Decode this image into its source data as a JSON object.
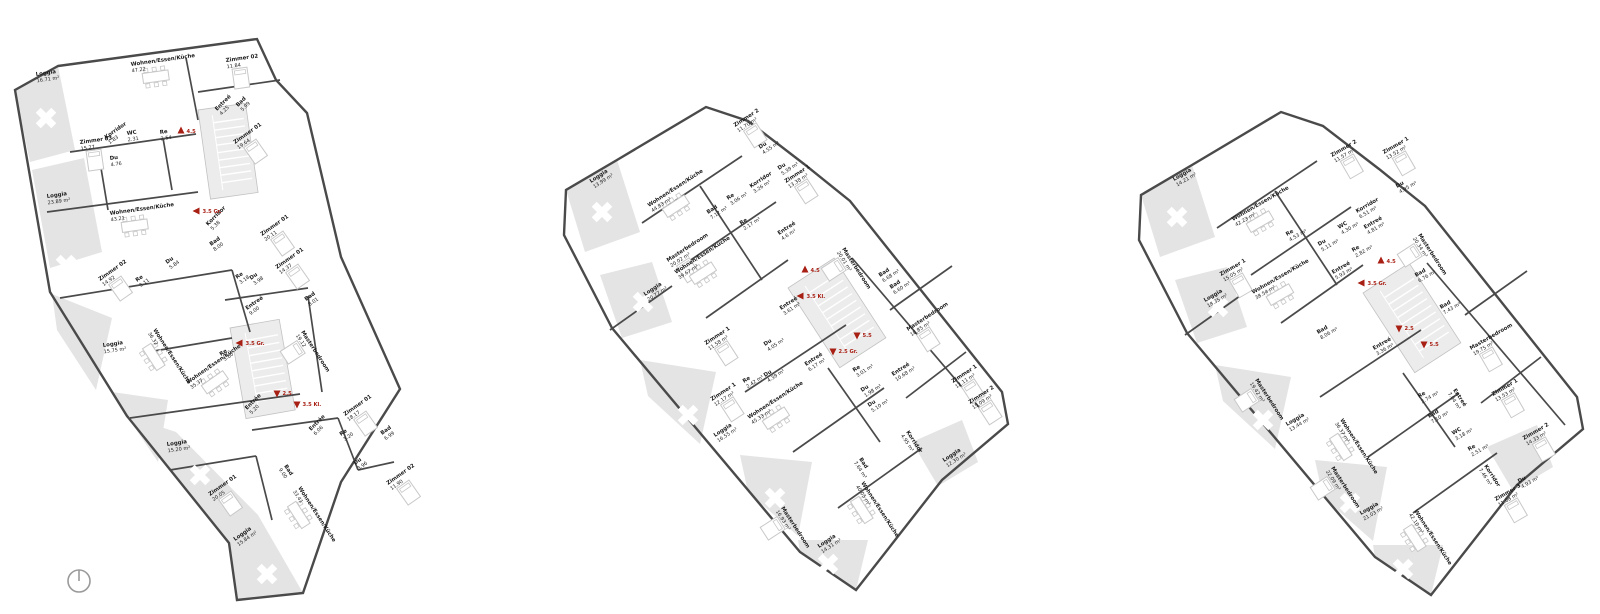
{
  "drawing": {
    "type": "architectural-floor-plans",
    "language": "de",
    "background": "#ffffff"
  },
  "colors": {
    "wall": "#4a4a4a",
    "light_detail": "#c8c8c8",
    "loggia_fill": "#e4e4e4",
    "stair_fill": "#ececec",
    "stair_edge": "#c2c2c2",
    "marker_red": "#a81f14",
    "text": "#1c1c1c",
    "north_arrow": "#9a9a9a"
  },
  "plans": [
    {
      "id": "floor-plan-left",
      "angle": -8,
      "rooms": [
        [
          "Loggia",
          "16.71 m²",
          36,
          76,
          -8
        ],
        [
          "Wohnen/Essen/Küche",
          "47.22",
          131,
          66,
          -8
        ],
        [
          "Zimmer 02",
          "11.84",
          226,
          62,
          -8
        ],
        [
          "Entreé",
          "4.25",
          217,
          111,
          -45
        ],
        [
          "Bad",
          "5.99",
          238,
          107,
          -45
        ],
        [
          "Zimmer 01",
          "19.64",
          235,
          144,
          -35
        ],
        [
          "Zimmer 03",
          "15.27",
          80,
          144,
          -8
        ],
        [
          "Korridor",
          "1.83",
          106,
          139,
          -35
        ],
        [
          "WC",
          "2.31",
          127,
          135,
          -8
        ],
        [
          "Re",
          "2.54",
          160,
          134,
          -8
        ],
        [
          "Du",
          "4.76",
          110,
          160,
          -8
        ],
        [
          "Loggia",
          "23.89 m²",
          47,
          198,
          -8
        ],
        [
          "Wohnen/Essen/Küche",
          "43.21",
          110,
          215,
          -8
        ],
        [
          "Korridor",
          "5.38",
          208,
          226,
          -45
        ],
        [
          "Bad",
          "8.00",
          211,
          246,
          -35
        ],
        [
          "Zimmer 01",
          "20.11",
          262,
          236,
          -35
        ],
        [
          "Du",
          "5.84",
          167,
          264,
          -35
        ],
        [
          "Zimmer 02",
          "14.92",
          100,
          281,
          -35
        ],
        [
          "Re",
          "3.11",
          137,
          282,
          -35
        ],
        [
          "Re",
          "3.18",
          237,
          279,
          -35
        ],
        [
          "Du",
          "3.98",
          251,
          280,
          -35
        ],
        [
          "Zimmer 01",
          "14.37",
          277,
          269,
          -35
        ],
        [
          "Bad",
          "8.01",
          306,
          301,
          -35
        ],
        [
          "Entreé",
          "9.00",
          247,
          310,
          -35
        ],
        [
          "Wohnen/Essen/Küche",
          "36.32",
          153,
          330,
          57
        ],
        [
          "Loggia",
          "15.75 m²",
          103,
          347,
          -8
        ],
        [
          "Masterbedroom",
          "19.12",
          301,
          332,
          57
        ],
        [
          "Re",
          "3.60",
          221,
          356,
          -35
        ],
        [
          "Wohnen/Essen/Küche",
          "35.37",
          188,
          384,
          -35
        ],
        [
          "Entrée",
          "5.20",
          247,
          410,
          -45
        ],
        [
          "Loggia",
          "15.20 m²",
          167,
          446,
          -8
        ],
        [
          "Bad",
          "9.00",
          284,
          466,
          57
        ],
        [
          "Zimmer 01",
          "20.05",
          210,
          496,
          -35
        ],
        [
          "Wohnen/Essen/Küche",
          "33.41",
          298,
          488,
          57
        ],
        [
          "Loggia",
          "15.84 m²",
          235,
          541,
          -35
        ],
        [
          "Zimmer 01",
          "18.17",
          345,
          416,
          -35
        ],
        [
          "Entrée",
          "6.06",
          311,
          431,
          -45
        ],
        [
          "Re",
          "3.20",
          341,
          436,
          -35
        ],
        [
          "Bad",
          "6.99",
          382,
          435,
          -35
        ],
        [
          "Du",
          "3.96",
          355,
          465,
          -35
        ],
        [
          "Zimmer 02",
          "11.90",
          388,
          485,
          -35
        ]
      ],
      "markers": [
        [
          "4.5",
          181,
          131,
          "up"
        ],
        [
          "3.5 Gr.",
          197,
          211,
          "left"
        ],
        [
          "3.5 Gr.",
          240,
          343,
          "left"
        ],
        [
          "2.5",
          277,
          393,
          "down"
        ],
        [
          "3.5 Kl.",
          297,
          404,
          "down"
        ]
      ]
    },
    {
      "id": "floor-plan-middle",
      "angle": -33,
      "rooms": [
        [
          "Loggia",
          "13.99 m²",
          591,
          183,
          -33
        ],
        [
          "Zimmer 2",
          "11.70 m²",
          735,
          127,
          -33
        ],
        [
          "Du",
          "4.55 m²",
          760,
          149,
          -33
        ],
        [
          "Du",
          "5.39 m²",
          779,
          170,
          -33
        ],
        [
          "Zimmer 1",
          "13.38 m²",
          786,
          183,
          -33
        ],
        [
          "Korridor",
          "3.26 m²",
          751,
          188,
          -33
        ],
        [
          "Re",
          "3.06 m²",
          728,
          200,
          -33
        ],
        [
          "Bad",
          "7.12 m²",
          708,
          214,
          -33
        ],
        [
          "Re",
          "2.17 m²",
          741,
          225,
          -33
        ],
        [
          "Entreé",
          "4.6 m²",
          779,
          235,
          -33
        ],
        [
          "Wohnen/Essen/Küche",
          "44.83 m²",
          649,
          207,
          -33
        ],
        [
          "Masterbedroom",
          "20.02 m²",
          668,
          262,
          -33
        ],
        [
          "Wohnen/Essen/Küche",
          "39.67 m²",
          676,
          274,
          -33
        ],
        [
          "Loggia",
          "20.77 m²",
          645,
          296,
          -33
        ],
        [
          "Masterbedroom",
          "20.01 m²",
          842,
          249,
          57
        ],
        [
          "Bad",
          "6.68 m²",
          880,
          277,
          -33
        ],
        [
          "Bad",
          "6.60 m²",
          891,
          289,
          -33
        ],
        [
          "Zimmer 1",
          "11.58 m²",
          706,
          345,
          -33
        ],
        [
          "Du",
          "4.05 m²",
          765,
          346,
          -33
        ],
        [
          "Entreé",
          "3.61 m²",
          781,
          310,
          -33
        ],
        [
          "Re",
          "2.42 m²",
          744,
          383,
          -33
        ],
        [
          "Du",
          "4.39 m²",
          765,
          377,
          -33
        ],
        [
          "Entreé",
          "6.17 m²",
          806,
          366,
          -33
        ],
        [
          "Zimmer 1",
          "12.17 m²",
          712,
          401,
          -33
        ],
        [
          "Wohnen/Essen/Küche",
          "45.33 m²",
          749,
          419,
          -33
        ],
        [
          "Loggia",
          "16.55 m²",
          715,
          437,
          -33
        ],
        [
          "Re",
          "3.01 m²",
          854,
          372,
          -33
        ],
        [
          "Du",
          "1.98 m²",
          862,
          392,
          -33
        ],
        [
          "Du",
          "5.10 m²",
          869,
          407,
          -33
        ],
        [
          "Entreé",
          "10.68 m²",
          893,
          376,
          -33
        ],
        [
          "Masterbedroom",
          "18.85 m²",
          908,
          331,
          -33
        ],
        [
          "Zimmer 1",
          "12.11 m²",
          953,
          383,
          -33
        ],
        [
          "Zimmer 2",
          "15.09 m²",
          970,
          404,
          -33
        ],
        [
          "Korridor",
          "4.95 m²",
          906,
          432,
          57
        ],
        [
          "Loggia",
          "12.30 m²",
          944,
          462,
          -33
        ],
        [
          "Bad",
          "7.64 m²",
          859,
          459,
          57
        ],
        [
          "Wohnen/Essen/Küche",
          "40.05 m²",
          861,
          483,
          57
        ],
        [
          "Masterbedroom",
          "16.93 m²",
          781,
          508,
          57
        ],
        [
          "Loggia",
          "14.31 m²",
          819,
          548,
          -33
        ]
      ],
      "markers": [
        [
          "4.5",
          805,
          270,
          "up"
        ],
        [
          "3.5 Kl.",
          801,
          296,
          "left"
        ],
        [
          "5.5",
          857,
          335,
          "down"
        ],
        [
          "2.5 Gr.",
          833,
          351,
          "down"
        ]
      ]
    },
    {
      "id": "floor-plan-right",
      "angle": -30,
      "rooms": [
        [
          "Loggia",
          "14.21 m²",
          1174,
          181,
          -30
        ],
        [
          "Zimmer 2",
          "11.57 m²",
          1332,
          157,
          -30
        ],
        [
          "Zimmer 1",
          "13.52 m²",
          1384,
          154,
          -30
        ],
        [
          "Du",
          "4.95 m²",
          1397,
          188,
          -30
        ],
        [
          "Wohnen/Essen/Küche",
          "42.23 m²",
          1233,
          221,
          -30
        ],
        [
          "Re",
          "4.53 m²",
          1287,
          236,
          -30
        ],
        [
          "Du",
          "5.11 m²",
          1319,
          246,
          -30
        ],
        [
          "WC",
          "4.30 m²",
          1339,
          229,
          -30
        ],
        [
          "Korridor",
          "6.51 m²",
          1357,
          213,
          -30
        ],
        [
          "Entreé",
          "4.81 m²",
          1365,
          229,
          -30
        ],
        [
          "Re",
          "2.82 m²",
          1353,
          252,
          -30
        ],
        [
          "Masterbedroom",
          "20.34 m²",
          1418,
          235,
          57
        ],
        [
          "Zimmer 1",
          "15.05 m²",
          1221,
          276,
          -30
        ],
        [
          "Loggia",
          "18.35 m²",
          1205,
          302,
          -30
        ],
        [
          "Wohnen/Essen/Küche",
          "38.54 m²",
          1253,
          294,
          -30
        ],
        [
          "Entreé",
          "5.93 m²",
          1333,
          274,
          -30
        ],
        [
          "Bad",
          "6.76 m²",
          1416,
          277,
          -30
        ],
        [
          "Bad",
          "7.43 m²",
          1441,
          309,
          -30
        ],
        [
          "Bad",
          "8.06 m²",
          1318,
          334,
          -30
        ],
        [
          "Entreé",
          "3.36 m²",
          1374,
          350,
          -30
        ],
        [
          "Masterbedroom",
          "19.42 m²",
          1255,
          380,
          57
        ],
        [
          "Loggia",
          "13.44 m²",
          1287,
          426,
          -30
        ],
        [
          "Wohnen/Essen/Küche",
          "36.37 m²",
          1340,
          420,
          57
        ],
        [
          "Masterbedroom",
          "22.09 m²",
          1331,
          468,
          57
        ],
        [
          "Loggia",
          "21.03 m²",
          1361,
          515,
          -30
        ],
        [
          "Wohnen/Essen/Küche",
          "42.10 m²",
          1414,
          511,
          57
        ],
        [
          "Re",
          "2.74 m²",
          1419,
          398,
          -30
        ],
        [
          "Bad",
          "7.10 m²",
          1429,
          418,
          -30
        ],
        [
          "WC",
          "3.18 m²",
          1453,
          435,
          -30
        ],
        [
          "Re",
          "2.51 m²",
          1469,
          451,
          -30
        ],
        [
          "Korridor",
          "7.46 m²",
          1484,
          466,
          57
        ],
        [
          "Zimmer 3",
          "11.08 m²",
          1496,
          501,
          -30
        ],
        [
          "Du",
          "4.93 m²",
          1519,
          483,
          -30
        ],
        [
          "Zimmer 2",
          "14.33 m²",
          1524,
          440,
          -30
        ],
        [
          "Zimmer 1",
          "13.53 m²",
          1493,
          396,
          -30
        ],
        [
          "Masterbedroom",
          "19.75 m²",
          1471,
          350,
          -30
        ],
        [
          "Entreé",
          "7.04 m²",
          1453,
          390,
          57
        ]
      ],
      "markers": [
        [
          "4.5",
          1381,
          261,
          "up"
        ],
        [
          "3.5 Gr.",
          1362,
          283,
          "left"
        ],
        [
          "2.5",
          1399,
          328,
          "down"
        ],
        [
          "5.5",
          1424,
          344,
          "down"
        ]
      ]
    }
  ]
}
